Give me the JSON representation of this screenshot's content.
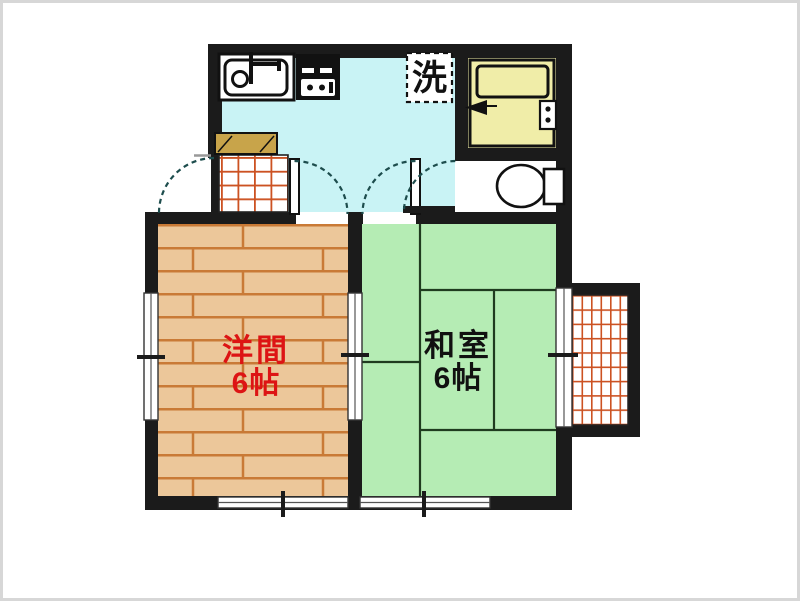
{
  "floorplan": {
    "labels": {
      "laundry_box": "洗",
      "western_room_name": "洋間",
      "western_room_size": "6帖",
      "japanese_room_name": "和室",
      "japanese_room_size": "6帖"
    },
    "colors": {
      "wall": "#1b1b1b",
      "kitchen_floor": "#c9f3f5",
      "bathroom_floor": "#f0eda8",
      "wood_floor": "#ecc79a",
      "wood_plank_line": "#c97a36",
      "tatami_floor": "#b5ecb4",
      "tatami_line": "#1f3b1f",
      "tile_grid_line": "#cc5222",
      "shoe_cabinet": "#c8a44a",
      "western_label_color": "#dd1414",
      "japanese_label_color": "#111111",
      "door_arc": "#1d4d4d",
      "canvas_border": "#d7d7d7"
    }
  }
}
